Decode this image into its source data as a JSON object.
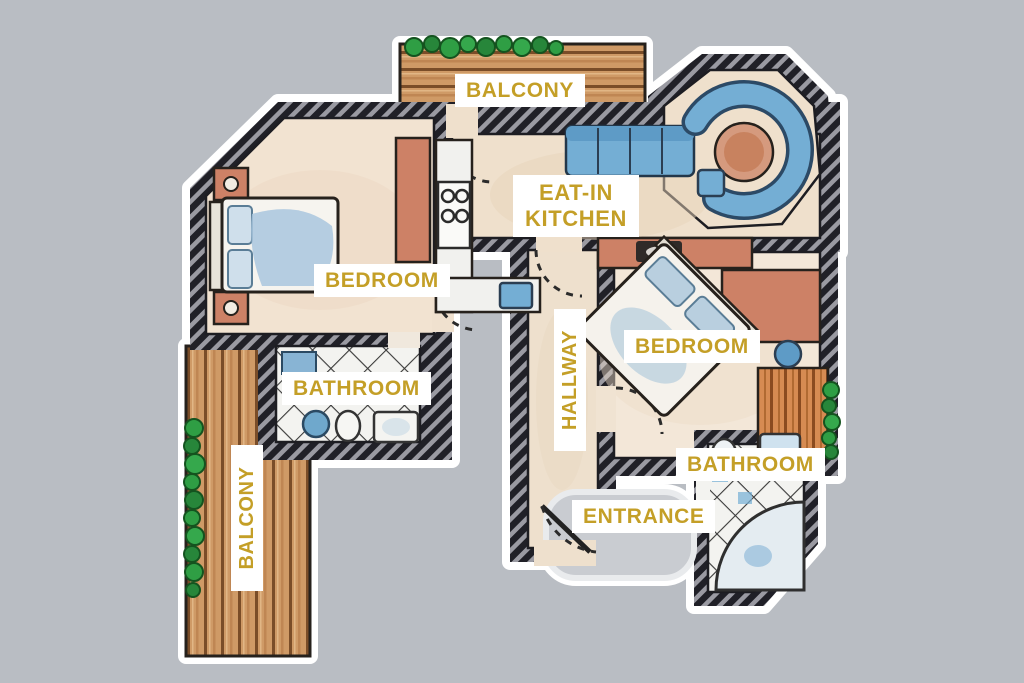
{
  "title": "Apartment floor plan",
  "rooms": {
    "balcony_top": {
      "label": "BALCONY"
    },
    "eat_in_kitchen": {
      "label_line1": "EAT-IN",
      "label_line2": "KITCHEN"
    },
    "bedroom_left": {
      "label": "BEDROOM"
    },
    "bathroom_left": {
      "label": "BATHROOM"
    },
    "balcony_left": {
      "label": "BALCONY"
    },
    "hallway": {
      "label": "HALLWAY"
    },
    "bedroom_right": {
      "label": "BEDROOM"
    },
    "bathroom_right": {
      "label": "BATHROOM"
    },
    "entrance": {
      "label": "ENTRANCE"
    }
  },
  "palette": {
    "background": "#b9bdc3",
    "label_text": "#c49f27",
    "label_background": "#ffffff",
    "wall_dark": "#202027",
    "floor_beige": "#efe0cc",
    "wood_brown": "#cf9a66",
    "plant_green": "#2f9e44",
    "furniture_salmon": "#cd8166",
    "accent_blue": "#74aed4"
  }
}
